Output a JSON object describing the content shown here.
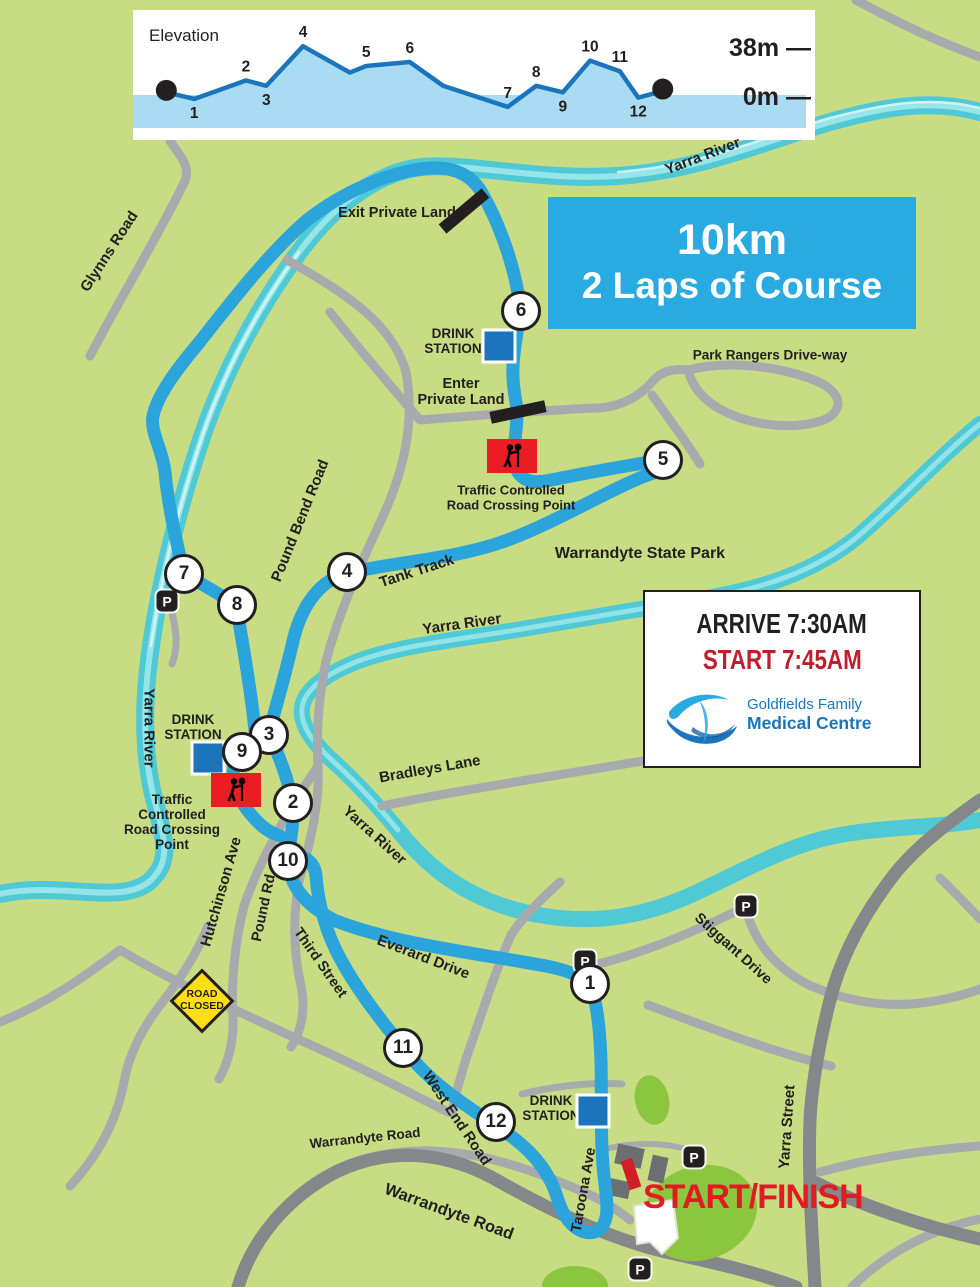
{
  "colors": {
    "background": "#C8DC84",
    "river": "#4EC9D5",
    "river_highlight": "#9FE8EA",
    "course_blue": "#2BA4DB",
    "road_minor": "#A8AAAD",
    "road_major": "#85878A",
    "title_box_blue": "#29ABE2",
    "drink_blue": "#1C75BB",
    "sign_red": "#EC1C24",
    "start_finish_red": "#E11B22",
    "start_time_crimson": "#BE1E2D",
    "road_closed_yellow": "#FFDE17",
    "park_green": "#8CC63E",
    "chart_fill": "#A9DCF2",
    "chart_line": "#1B75BC"
  },
  "chart_data": {
    "type": "area",
    "title": "Elevation",
    "ylabels": {
      "top": "38m —",
      "base": "0m —"
    },
    "unit": "m",
    "ylim": [
      0,
      38
    ],
    "points": [
      {
        "label": "start",
        "f": 0.049,
        "elev": 2,
        "dot": true
      },
      {
        "label": "1",
        "f": 0.09,
        "elev": -3,
        "side": "below"
      },
      {
        "label": "2",
        "f": 0.166,
        "elev": 11,
        "side": "above"
      },
      {
        "label": "3",
        "f": 0.196,
        "elev": 7,
        "side": "below"
      },
      {
        "label": "4",
        "f": 0.25,
        "elev": 37,
        "side": "above"
      },
      {
        "label": "",
        "f": 0.319,
        "elev": 17
      },
      {
        "label": "5",
        "f": 0.343,
        "elev": 22,
        "side": "above"
      },
      {
        "label": "6",
        "f": 0.407,
        "elev": 25,
        "side": "above"
      },
      {
        "label": "",
        "f": 0.456,
        "elev": 7
      },
      {
        "label": "7",
        "f": 0.551,
        "elev": -9,
        "side": "above"
      },
      {
        "label": "8",
        "f": 0.593,
        "elev": 7,
        "side": "above"
      },
      {
        "label": "9",
        "f": 0.632,
        "elev": 2,
        "side": "below"
      },
      {
        "label": "10",
        "f": 0.672,
        "elev": 26,
        "side": "above"
      },
      {
        "label": "11",
        "f": 0.716,
        "elev": 18,
        "side": "above"
      },
      {
        "label": "12",
        "f": 0.743,
        "elev": -2,
        "side": "below"
      },
      {
        "label": "finish",
        "f": 0.779,
        "elev": 3,
        "dot": true
      }
    ]
  },
  "title_box": {
    "line1": "10km",
    "line2": "2 Laps of Course"
  },
  "info_box": {
    "arrive": "ARRIVE 7:30AM",
    "start": "START 7:45AM",
    "clinic_line1": "Goldfields Family",
    "clinic_line2": "Medical Centre"
  },
  "start_finish": "START/FINISH",
  "parking_letter": "P",
  "signs": {
    "road_closed": "ROAD\nCLOSED",
    "traffic_top": "Traffic Controlled\nRoad Crossing Point",
    "traffic_left": "Traffic\nControlled\nRoad Crossing\nPoint",
    "drink_station": "DRINK\nSTATION",
    "exit_private": "Exit Private Land",
    "enter_private": "Enter\nPrivate Land"
  },
  "places": {
    "yarra_river": "Yarra River",
    "park_rangers": "Park Rangers Drive-way",
    "state_park": "Warrandyte State Park",
    "tank_track": "Tank Track",
    "bradleys": "Bradleys Lane",
    "glynns": "Glynns Road",
    "pound_bend": "Pound Bend Road",
    "hutchinson": "Hutchinson Ave",
    "pound_rd": "Pound Rd",
    "third": "Third Street",
    "everard": "Everard Drive",
    "stiggant": "Stiggant Drive",
    "west_end": "West End Road",
    "warrandyte_rd": "Warrandyte Road",
    "taroona": "Taroona Ave",
    "yarra_st": "Yarra Street"
  },
  "checkpoints": [
    "1",
    "2",
    "3",
    "4",
    "5",
    "6",
    "7",
    "8",
    "9",
    "10",
    "11",
    "12"
  ]
}
